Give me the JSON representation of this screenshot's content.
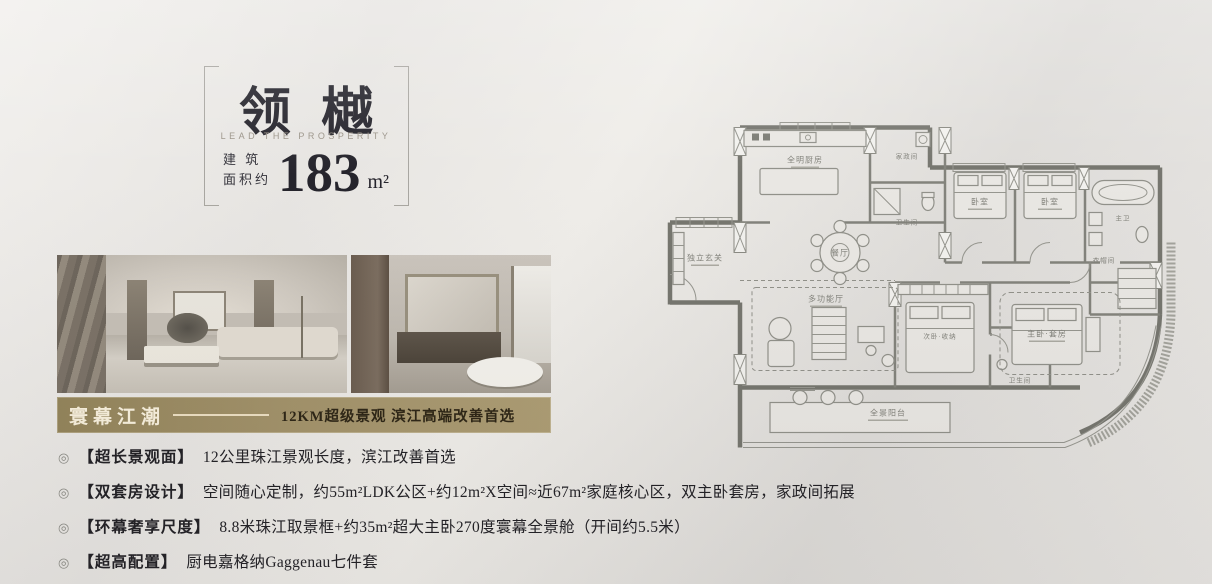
{
  "title_block": {
    "brand": "领樾",
    "subtitle": "LEAD THE PROSPERITY",
    "area_prefix_1": "建 筑",
    "area_prefix_2": "面积约",
    "area_value": "183",
    "area_unit": "m²"
  },
  "banner": {
    "title": "寰幕江潮",
    "tagline": "12KM超级景观  滨江高端改善首选",
    "bg_color": "#a2926a",
    "title_color": "#f8f0dd",
    "tagline_color": "#2e2616"
  },
  "bullets": [
    {
      "icon": "◎",
      "tag": "【超长景观面】",
      "text": "12公里珠江景观长度，滨江改善首选"
    },
    {
      "icon": "◎",
      "tag": "【双套房设计】",
      "text": "空间随心定制，约55m²LDK公区+约12m²X空间≈近67m²家庭核心区，双主卧套房，家政间拓展"
    },
    {
      "icon": "◎",
      "tag": "【环幕奢享尺度】",
      "text": "8.8米珠江取景框+约35m²超大主卧270度寰幕全景舱（开间约5.5米）"
    },
    {
      "icon": "◎",
      "tag": "【超高配置】",
      "text": "厨电嘉格纳Gaggenau七件套"
    }
  ],
  "floorplan": {
    "rooms": {
      "kitchen": "全明厨房",
      "laundry": "家政间",
      "bath_a": "卫生间",
      "dining": "餐厅",
      "foyer": "独立玄关",
      "bedroom_1": "卧室",
      "bedroom_2": "卧室",
      "master_bath": "主卫",
      "closet": "衣帽间",
      "flex": "多功能厅",
      "second_suite": "次卧·收纳",
      "bath_b": "卫生间",
      "master_suite": "主卧·套房",
      "balcony": "全景阳台"
    }
  }
}
